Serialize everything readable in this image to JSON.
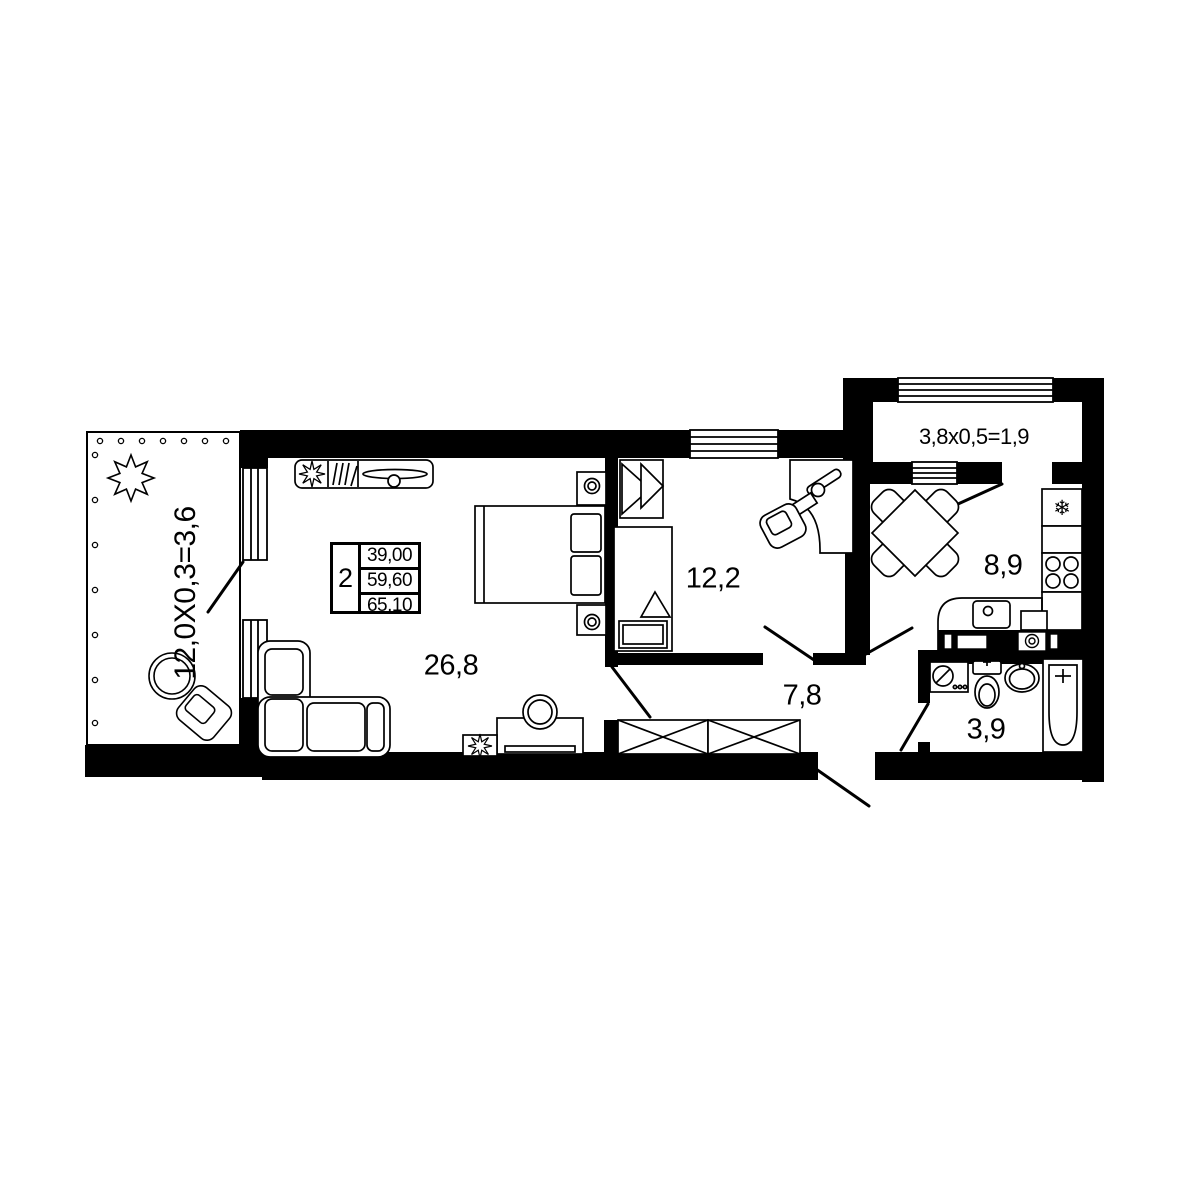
{
  "plan": {
    "labels": {
      "living": "26,8",
      "bedroom": "12,2",
      "hallway": "7,8",
      "kitchen": "8,9",
      "bathroom": "3,9",
      "balcony_left": "12,0X0,3=3,6",
      "balcony_top": "3,8x0,5=1,9"
    },
    "spec": {
      "rooms": "2",
      "living_area": "39,00",
      "area_wo_balcony": "59,60",
      "total_area": "65,10"
    },
    "icons": {
      "fridge": "❄"
    },
    "colors": {
      "wall": "#000000",
      "background": "#ffffff"
    }
  }
}
